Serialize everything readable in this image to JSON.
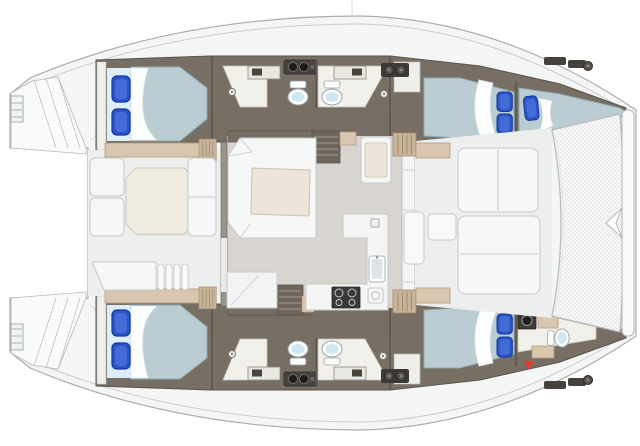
{
  "scene": {
    "type": "floor-plan",
    "subject": "catamaran-yacht",
    "view": "top-down",
    "orientation": "bow-right",
    "background": "#ffffff"
  },
  "colors": {
    "deck": "#f4f5f5",
    "deck-line": "#a8acaf",
    "sheer-line": "#c9cccd",
    "floor-dark": "#776e64",
    "floor-dark-line": "#5b544c",
    "plank-line": "#6a6157",
    "wood-tan": "#d9c6ae",
    "wood-tan-dark": "#b29a7e",
    "wood-stripe": "#c9b499",
    "wood-stripe-dark": "#a08a6f",
    "head-floor": "#f1f0ea",
    "head-floor-line": "#c8c4ba",
    "salon-floor": "#d8d5d1",
    "cockpit-floor": "#edefee",
    "seat-white": "#f6f7f7",
    "seat-line": "#c6c9ca",
    "table-cream": "#ece5d8",
    "table-line": "#c9c1b0",
    "cockpit-table": "#f1ece1",
    "mattress": "#b9cdd2",
    "mattress-line": "#8ea9b0",
    "mattress-head": "#ddeef6",
    "pillow": "#2a55c8",
    "pillow-dark": "#17379d",
    "pillow-light": "#5c83e3",
    "sheet": "#fcfdfd",
    "sheet-line": "#dfe5e7",
    "dark-unit": "#3e3b38",
    "steps": "#6e665c",
    "steps-tread": "#a39a8e",
    "wall": "#9b948a",
    "toilet-line": "#9aa4a8",
    "toilet-bowl": "#cfe7f2",
    "tramp": "#f7f7f7",
    "tramp-dot": "#dedede",
    "tramp-line": "#b9bec1",
    "transom": "#f9fafa",
    "transom-line": "#b5b9bc",
    "marker-red": "#e8392b"
  },
  "inventory": {
    "double_berths": 4,
    "single_berths": 1,
    "toilets": 5,
    "vanity_sink_units": 4,
    "galley_sinks": 1,
    "stoves": 1,
    "companionway_stairs": 2,
    "tables": 3,
    "trampolines": 1,
    "boarding_ladders": 2,
    "red_markers": 1
  },
  "regions": [
    {
      "id": "aft-cabin-port"
    },
    {
      "id": "heads-port"
    },
    {
      "id": "forward-cabin-port"
    },
    {
      "id": "forepeak-berth-port"
    },
    {
      "id": "salon"
    },
    {
      "id": "galley"
    },
    {
      "id": "aft-cockpit"
    },
    {
      "id": "forward-cockpit"
    },
    {
      "id": "trampoline"
    },
    {
      "id": "aft-cabin-starboard"
    },
    {
      "id": "heads-starboard"
    },
    {
      "id": "forward-cabin-starboard"
    },
    {
      "id": "forward-head-starboard"
    },
    {
      "id": "transom-platforms"
    }
  ],
  "marker": {
    "shape": "triangle-down",
    "color": "#e8392b"
  }
}
